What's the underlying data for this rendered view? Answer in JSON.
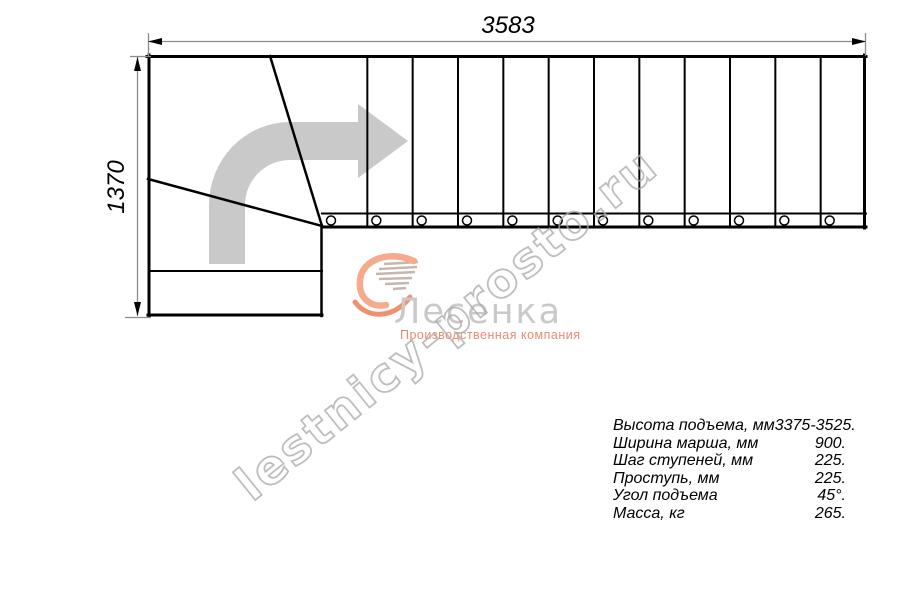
{
  "drawing": {
    "width_dim": "3583",
    "height_dim": "1370",
    "tread_count": 12,
    "line_color": "#000000",
    "dim_line_color": "#8c8c8c",
    "direction_arrow_color": "#c9c9c9"
  },
  "watermark": {
    "text": "lestnicy-prosto.ru",
    "color": "#a8a8a8"
  },
  "logo": {
    "name": "Лесенка",
    "tagline": "Производственная компания",
    "accent_color": "#F29C7E",
    "name_color": "#c9c9c9"
  },
  "specs": {
    "rows": [
      {
        "label": "Высота подъема, мм",
        "value": "3375-3525."
      },
      {
        "label": "Ширина марша, мм",
        "value": "900."
      },
      {
        "label": "Шаг ступеней, мм",
        "value": "225."
      },
      {
        "label": "Проступь, мм",
        "value": "225."
      },
      {
        "label": "Угол подъема",
        "value": "45°."
      },
      {
        "label": "Масса, кг",
        "value": "265."
      }
    ]
  }
}
